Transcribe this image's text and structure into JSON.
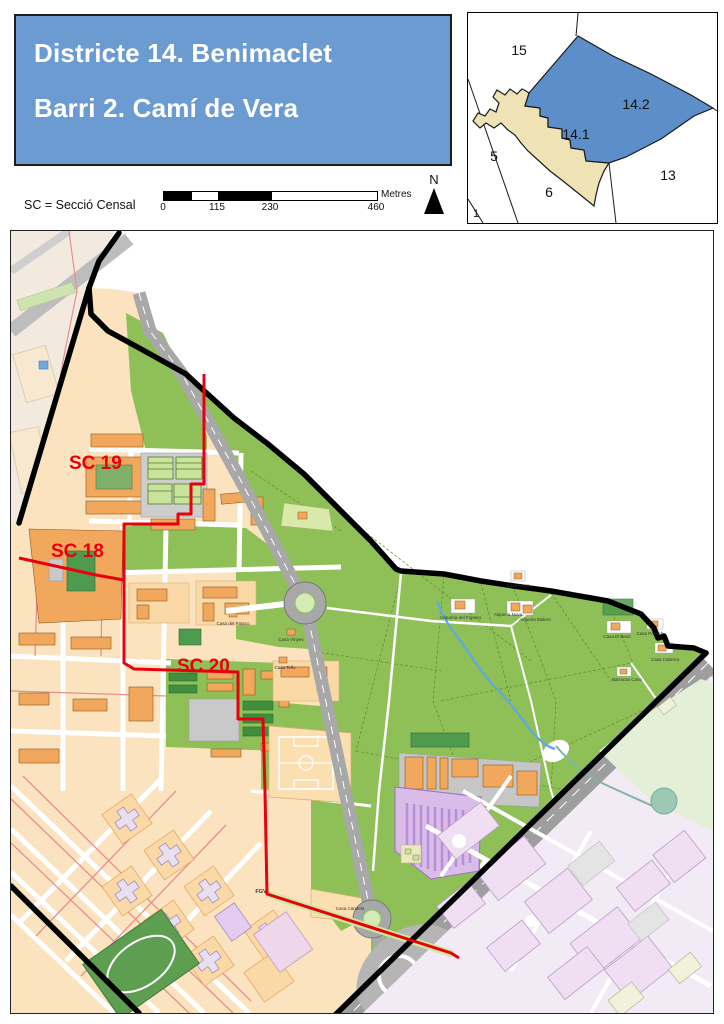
{
  "header": {
    "title_line1": "Districte 14. Benimaclet",
    "title_line2": "Barri 2. Camí de Vera",
    "sc_note": "SC = Secció Censal"
  },
  "scalebar": {
    "tick0": "0",
    "tick1": "115",
    "tick2": "230",
    "tick3": "460",
    "unit": "Metres"
  },
  "north_label": "N",
  "inset": {
    "district_15": "15",
    "district_5": "5",
    "district_6": "6",
    "district_13": "13",
    "district_1": "1",
    "barri_141": "14.1",
    "barri_142": "14.2"
  },
  "map": {
    "sc19": "SC 19",
    "sc18": "SC 18",
    "sc20": "SC 20",
    "fgv": "FGV",
    "places": {
      "casa_del_pataco": "Casa del Pataco",
      "casa_vinyes": "Casa Vinyes",
      "casa_tello": "Casa Tello",
      "casa_maya": "Casa Maya",
      "alqueria_figuero": "Alqueria del Figuero",
      "alqueria_nova": "Alqueria Nova",
      "alqueria_molero": "Alqueria Molero",
      "casa_beso": "Casa El Besó",
      "casa_panach": "Casa Panach",
      "casa_cabrera": "Casa Cabrera",
      "barracas_cano": "Barracas Cano",
      "casa_candela": "Casa Candela"
    }
  },
  "colors": {
    "title_bg": "#6B9BD1",
    "barri_highlight": "#5C8FC9",
    "barri_neighbor": "#EFE2B4",
    "section_red": "#E8000D",
    "huerta_green": "#8FC057",
    "building_orange": "#F1A85D",
    "road_gray": "#A8A8A8"
  }
}
